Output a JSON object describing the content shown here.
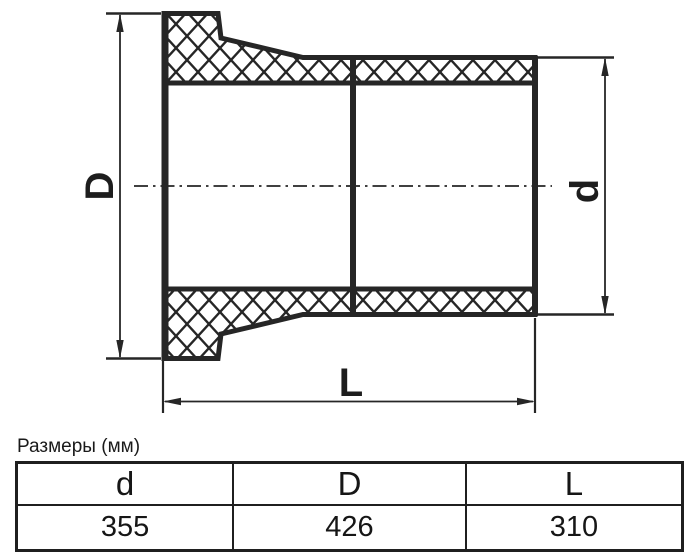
{
  "colors": {
    "line": "#262626",
    "text": "#1a1a1a",
    "background": "#ffffff"
  },
  "drawing": {
    "labels": {
      "outer_diameter": "D",
      "inner_diameter": "d",
      "length": "L"
    }
  },
  "table": {
    "caption": "Размеры (мм)",
    "columns": [
      "d",
      "D",
      "L"
    ],
    "rows": [
      [
        "355",
        "426",
        "310"
      ]
    ]
  },
  "dimensions_mm": {
    "d": 355,
    "D": 426,
    "L": 310
  }
}
